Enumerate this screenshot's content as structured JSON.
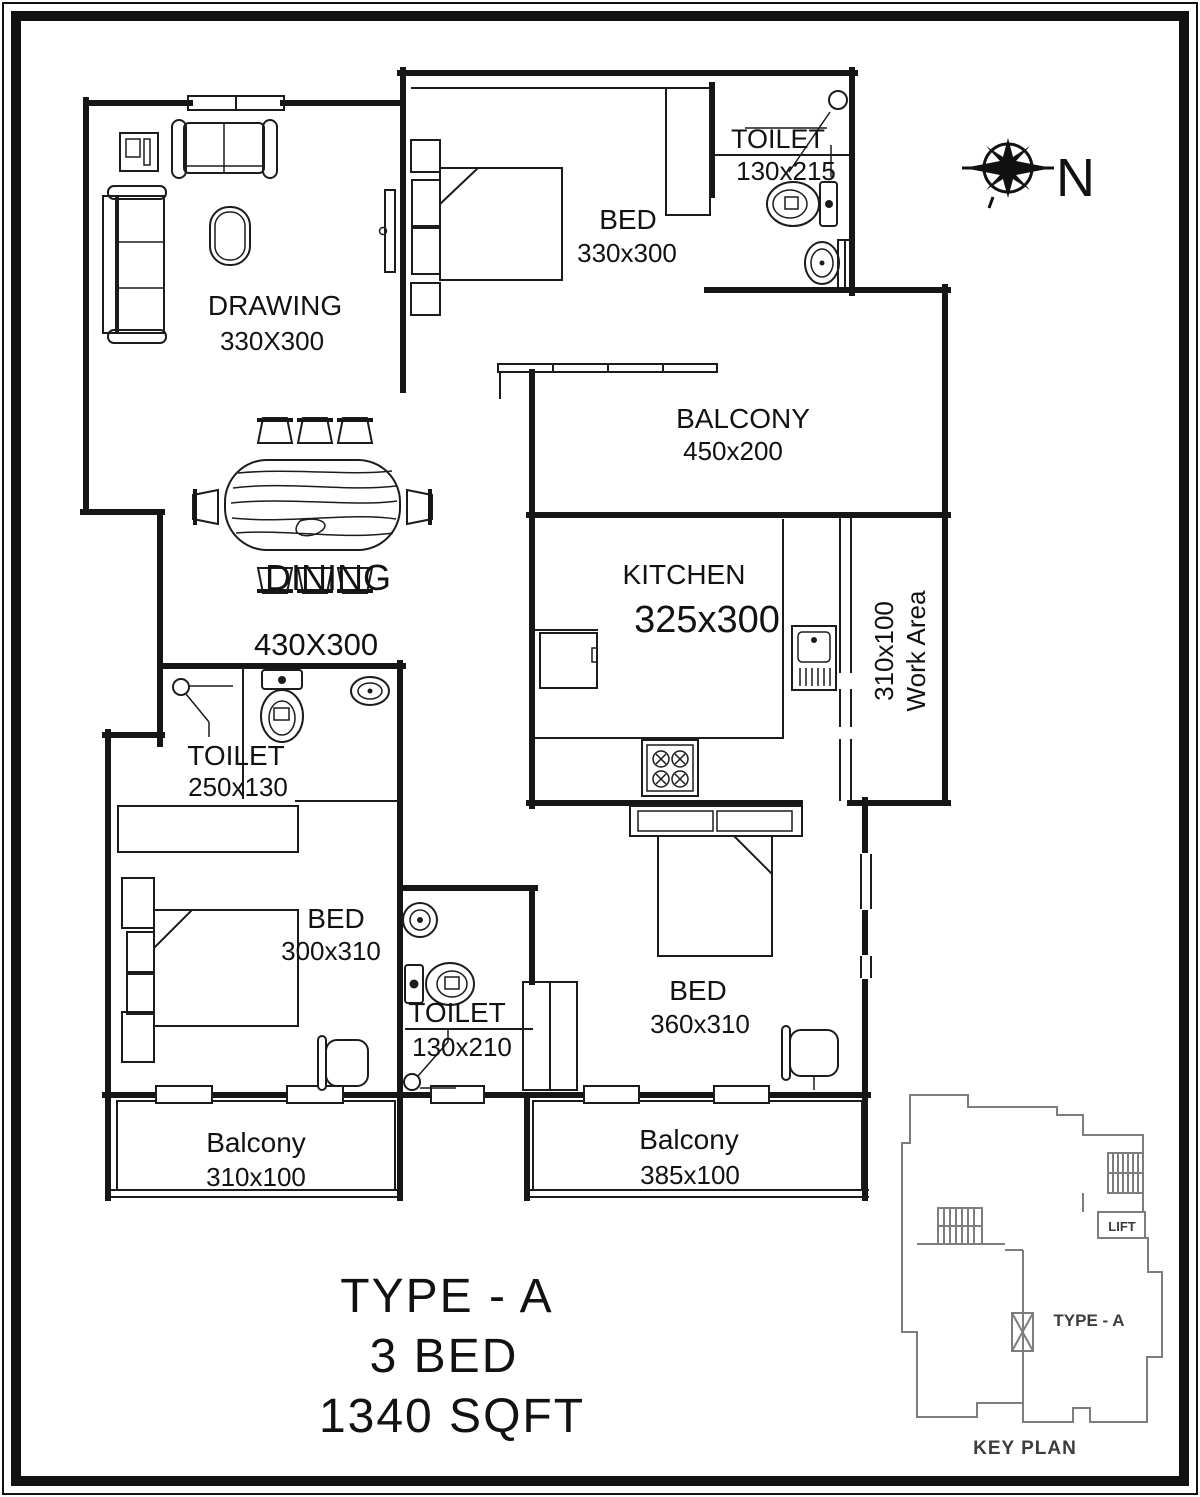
{
  "title_block": {
    "line1": "TYPE - A",
    "line2": "3 BED",
    "line3": "1340 SQFT"
  },
  "compass": {
    "north_label": "N"
  },
  "rooms": {
    "drawing": {
      "name": "DRAWING",
      "dims": "330X300"
    },
    "bed1": {
      "name": "BED",
      "dims": "330x300"
    },
    "toilet1": {
      "name": "TOILET",
      "dims": "130x215"
    },
    "balcony_top": {
      "name": "BALCONY",
      "dims": "450x200"
    },
    "kitchen": {
      "name": "KITCHEN",
      "dims": "325x300"
    },
    "work_area": {
      "name": "Work Area",
      "dims": "310x100"
    },
    "dining": {
      "name": "DINING",
      "dims": "430X300"
    },
    "toilet2": {
      "name": "TOILET",
      "dims": "250x130"
    },
    "bed2": {
      "name": "BED",
      "dims": "300x310"
    },
    "toilet3": {
      "name": "TOILET",
      "dims": "130x210"
    },
    "bed3": {
      "name": "BED",
      "dims": "360x310"
    },
    "balcony_bl": {
      "name": "Balcony",
      "dims": "310x100"
    },
    "balcony_br": {
      "name": "Balcony",
      "dims": "385x100"
    }
  },
  "key_plan": {
    "caption": "KEY PLAN",
    "unit": "TYPE - A",
    "lift": "LIFT"
  },
  "colors": {
    "ink": "#161616",
    "key_plan_line": "#7d7d7d",
    "paper": "#ffffff"
  }
}
